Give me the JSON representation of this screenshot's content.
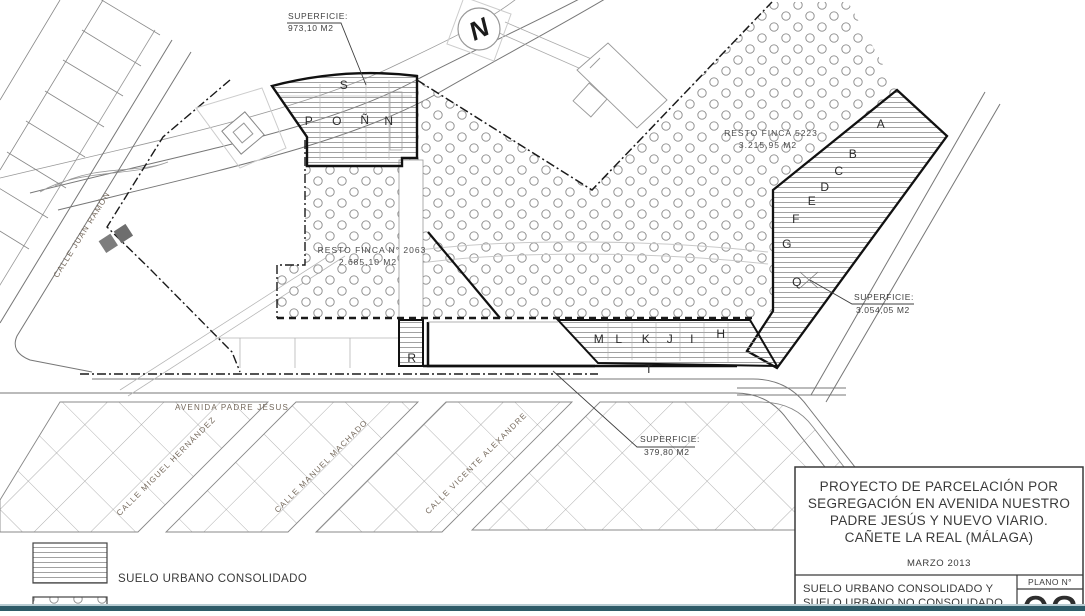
{
  "north": {
    "label": "N"
  },
  "labels": {
    "superficie_top": {
      "title": "SUPERFICIE:",
      "value": "973,10 M2"
    },
    "superficie_right": {
      "title": "SUPERFICIE:",
      "value": "3.054,05 M2"
    },
    "superficie_bottom": {
      "title": "SUPERFICIE:",
      "value": "379,80 M2"
    },
    "resto_finca_1": {
      "title": "RESTO FINCA N° 2063",
      "value": "2.685,10 M2"
    },
    "resto_finca_2": {
      "title": "RESTO FINCA 5223",
      "value": "3.215,95 M2"
    }
  },
  "streets": {
    "juan_ramon": "CALLE JUAN RAMÓN",
    "avenida": "AVENIDA PADRE JESUS",
    "miguel": "CALLE MIGUEL HERNÁNDEZ",
    "machado": "CALLE MANUEL MACHADO",
    "alexandre": "CALLE VICENTE ALEXANDRE"
  },
  "letters": {
    "s": "S",
    "p": "P",
    "o": "O",
    "nn": "Ñ",
    "n": "N",
    "a": "A",
    "b": "B",
    "c": "C",
    "d": "D",
    "e": "E",
    "f": "F",
    "g": "G",
    "q": "Q",
    "m": "M",
    "l": "L",
    "k": "K",
    "j": "J",
    "i": "I",
    "h": "H",
    "t": "T",
    "r": "R"
  },
  "legend": {
    "consolidado": "SUELO URBANO CONSOLIDADO"
  },
  "title_block": {
    "line1": "PROYECTO DE PARCELACIÓN POR",
    "line2": "SEGREGACIÓN EN AVENIDA NUESTRO",
    "line3": "PADRE JESÚS Y NUEVO VIARIO.",
    "line4": "CAÑETE LA REAL (MÁLAGA)",
    "date": "MARZO 2013",
    "subtitle1": "SUELO URBANO CONSOLIDADO Y",
    "subtitle2": "SUELO URBANO NO CONSOLIDADO",
    "plano_label": "PLANO N°",
    "plano_number": "03"
  },
  "colors": {
    "accent_bar": "#2e5b68",
    "linework": "#111111",
    "hatch": "#8a8a8a"
  }
}
